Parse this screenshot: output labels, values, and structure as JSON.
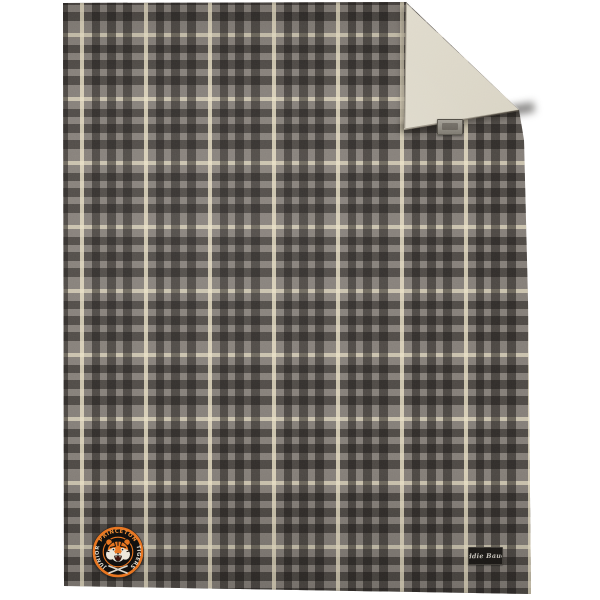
{
  "page": {
    "background_color": "#ffffff",
    "alt": "Gray plaid fleece blanket with top-right corner folded over showing cream sherpa lining, circular tiger team patch at lower left, black script brand tag at lower right"
  },
  "blanket": {
    "plaid": {
      "base_color": "#837d77",
      "dark_stripe_color": "#3c3936",
      "cream_stripe_color": "#e7dec2",
      "repeat_px": 64
    },
    "sherpa_color": "#dbd6c7",
    "patch": {
      "text_top": "PRINCETON",
      "text_left": "JUNIOR",
      "text_right": "TIGERS",
      "ring_color": "#e8721d",
      "field_color": "#0f0e0d",
      "top_text_color": "#ee8a32",
      "side_text_color": "#ddd8cc"
    },
    "brand_tag": {
      "label": "Eddie Bauer",
      "bg_color": "#191715",
      "text_color": "#c2beb6"
    },
    "fold_tag": {
      "bg_color": "#938f86"
    }
  }
}
